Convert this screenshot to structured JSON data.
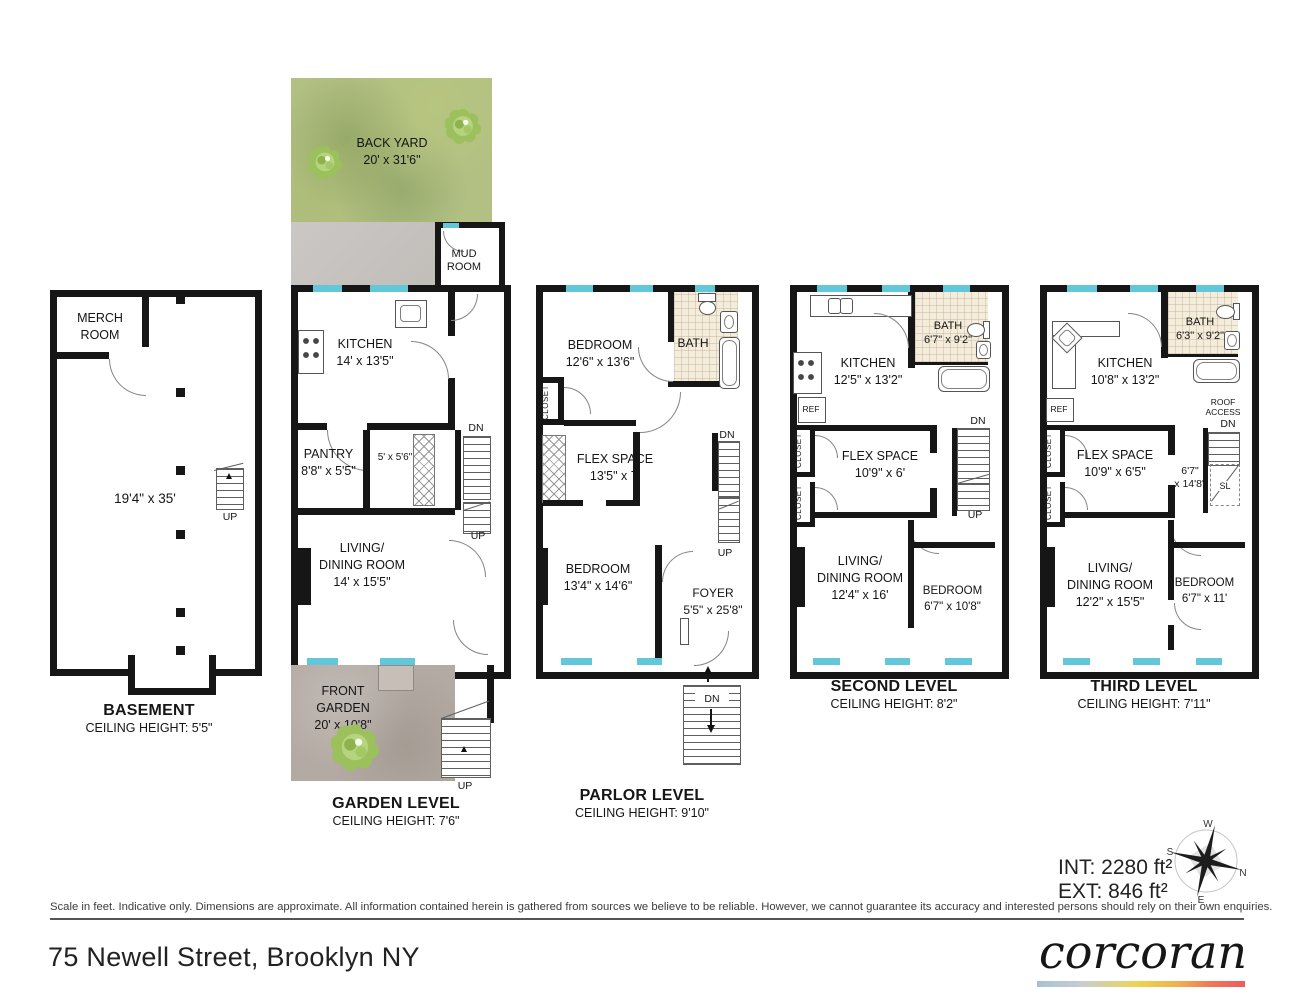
{
  "plans": {
    "basement": {
      "title": "BASEMENT",
      "ceiling": "CEILING HEIGHT: 5'5\"",
      "merch_room": "MERCH\nROOM",
      "dims": "19'4\" x 35'",
      "up": "UP"
    },
    "garden": {
      "title": "GARDEN LEVEL",
      "ceiling": "CEILING HEIGHT: 7'6\"",
      "back_yard": "BACK YARD\n20' x 31'6\"",
      "mud_room": "MUD\nROOM",
      "kitchen": "KITCHEN\n14' x 13'5\"",
      "pantry": "PANTRY\n8'8\" x 5'5\"",
      "closet_dims": "5' x 5'6\"",
      "dn": "DN",
      "up_mid": "UP",
      "living": "LIVING/\nDINING ROOM\n14' x 15'5\"",
      "front_garden": "FRONT\nGARDEN\n20' x 10'8\"",
      "up_stoop": "UP"
    },
    "parlor": {
      "title": "PARLOR LEVEL",
      "ceiling": "CEILING HEIGHT: 9'10\"",
      "bedroom1": "BEDROOM\n12'6\" x 13'6\"",
      "bath": "BATH",
      "closet": "CLOSET",
      "flex": "FLEX SPACE\n13'5\" x 7'",
      "dn_stairs": "DN",
      "up_stairs": "UP",
      "bedroom2": "BEDROOM\n13'4\" x 14'6\"",
      "foyer": "FOYER\n5'5\" x 25'8\"",
      "dn_stoop": "DN"
    },
    "second": {
      "title": "SECOND LEVEL",
      "ceiling": "CEILING HEIGHT: 8'2\"",
      "kitchen": "KITCHEN\n12'5\" x 13'2\"",
      "bath": "BATH\n6'7\" x 9'2\"",
      "ref": "REF",
      "closet1": "CLOSET",
      "closet2": "CLOSET",
      "flex": "FLEX SPACE\n10'9\" x 6'",
      "dn": "DN",
      "up": "UP",
      "living": "LIVING/\nDINING ROOM\n12'4\" x 16'",
      "bedroom": "BEDROOM\n6'7\" x 10'8\""
    },
    "third": {
      "title": "THIRD LEVEL",
      "ceiling": "CEILING HEIGHT: 7'11\"",
      "kitchen": "KITCHEN\n10'8\" x 13'2\"",
      "bath": "BATH\n6'3\" x 9'2\"",
      "ref": "REF",
      "roof_access": "ROOF\nACCESS",
      "closet1": "CLOSET",
      "closet2": "CLOSET",
      "flex": "FLEX SPACE\n10'9\" x 6'5\"",
      "hall_dims": "6'7\"\nx 14'8\"",
      "sl": "SL",
      "dn": "DN",
      "living": "LIVING/\nDINING ROOM\n12'2\" x 15'5\"",
      "bedroom": "BEDROOM\n6'7\" x 11'"
    }
  },
  "footer": {
    "int_area": "INT: 2280 ft²",
    "ext_area": "EXT: 846 ft²",
    "compass": {
      "n": "N",
      "s": "S",
      "e": "E",
      "w": "W"
    },
    "disclaimer": "Scale in feet. Indicative only. Dimensions are approximate. All information contained herein is gathered from sources we believe to be reliable. However, we cannot guarantee its accuracy and interested persons should rely on their own enquiries.",
    "address": "75 Newell Street, Brooklyn NY",
    "brand": "corcoran"
  },
  "colors": {
    "wall": "#161616",
    "window": "#62c7d9",
    "back_yard_green": "#b2c084",
    "front_garden_taupe": "#b3aaa3",
    "bath_tile": "#f4eddc",
    "brand_gradient": [
      "#a9c0d4",
      "#ecd54f",
      "#ec5a60"
    ]
  }
}
